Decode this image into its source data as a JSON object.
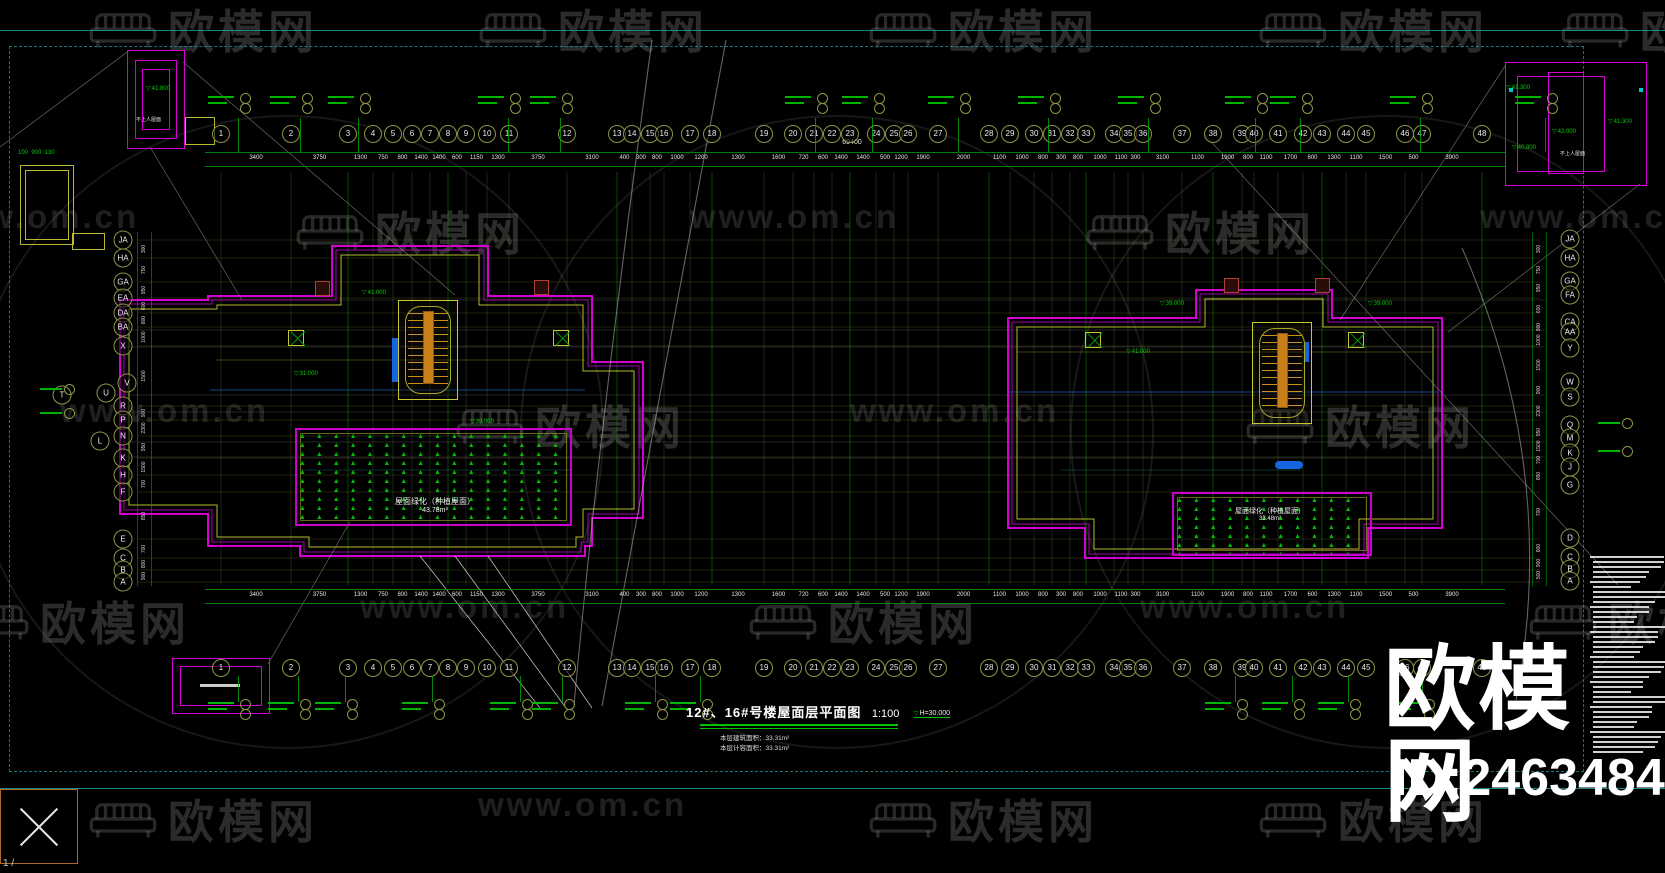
{
  "watermark": {
    "brand": "欧模网",
    "site": "www.om.cn",
    "big_brand": "欧模网",
    "id_text": "ID:2463484"
  },
  "viewer": {
    "page_indicator": "1 /"
  },
  "title_block": {
    "title": "12#、16#号楼屋面层平面图",
    "scale": "1:100",
    "height_mark": "H=30.000",
    "area_line_1": "本层建筑面积：33.31m²",
    "area_line_2": "本层计容面积：33.31m²"
  },
  "axes": {
    "top_numbers": [
      "1",
      "2",
      "3",
      "4",
      "5",
      "6",
      "7",
      "8",
      "9",
      "10",
      "11",
      "12",
      "13",
      "14",
      "15",
      "16",
      "17",
      "18",
      "19",
      "20",
      "21",
      "22",
      "23",
      "24",
      "25",
      "26",
      "27",
      "28",
      "29",
      "30",
      "31",
      "32",
      "33",
      "34",
      "35",
      "36",
      "37",
      "38",
      "39",
      "40",
      "41",
      "42",
      "43",
      "44",
      "45",
      "46",
      "47",
      "48"
    ],
    "left_letters": [
      "JA",
      "HA",
      "GA",
      "EA",
      "DA",
      "BA",
      "X",
      "V",
      "U",
      "T",
      "R",
      "P",
      "N",
      "L",
      "K",
      "H",
      "F",
      "E",
      "C",
      "B",
      "A"
    ],
    "right_letters": [
      "JA",
      "HA",
      "GA",
      "FA",
      "CA",
      "AA",
      "Y",
      "W",
      "S",
      "Q",
      "M",
      "K",
      "J",
      "G",
      "D",
      "C",
      "B",
      "A"
    ],
    "overall_dim": "69400",
    "dims": [
      "3400",
      "3750",
      "1300",
      "750",
      "800",
      "1400",
      "1400",
      "600",
      "1150",
      "1300",
      "3750",
      "3100",
      "400",
      "300",
      "800",
      "1000",
      "1200",
      "1300",
      "1600",
      "720",
      "600",
      "1400",
      "1400",
      "500",
      "1200",
      "1900",
      "2000",
      "1100",
      "1000",
      "800",
      "300",
      "800",
      "1000",
      "1100",
      "300",
      "3100",
      "1100",
      "1900",
      "800",
      "1100",
      "1700",
      "600",
      "1300",
      "1100",
      "1500",
      "500",
      "3900"
    ],
    "side_dims": [
      "300",
      "750",
      "950",
      "600",
      "800",
      "1000",
      "1500",
      "900",
      "2300",
      "950",
      "1500",
      "700",
      "850",
      "700",
      "800",
      "900",
      "500",
      "600"
    ]
  },
  "annotations": {
    "non_access_roof": "不上人屋面",
    "green_roof_label": "屋面绿化（种植屋面）",
    "left_green_area": "43.78m²",
    "right_green_area": "33.48m²",
    "elev_marker_glyph": "▽",
    "elevations": {
      "e39": "39.000",
      "e41": "41.000",
      "e31": "31.000",
      "e41_3": "41.300",
      "e41_8": "41.800",
      "e42": "42.000",
      "e40_8": "40.800"
    }
  }
}
